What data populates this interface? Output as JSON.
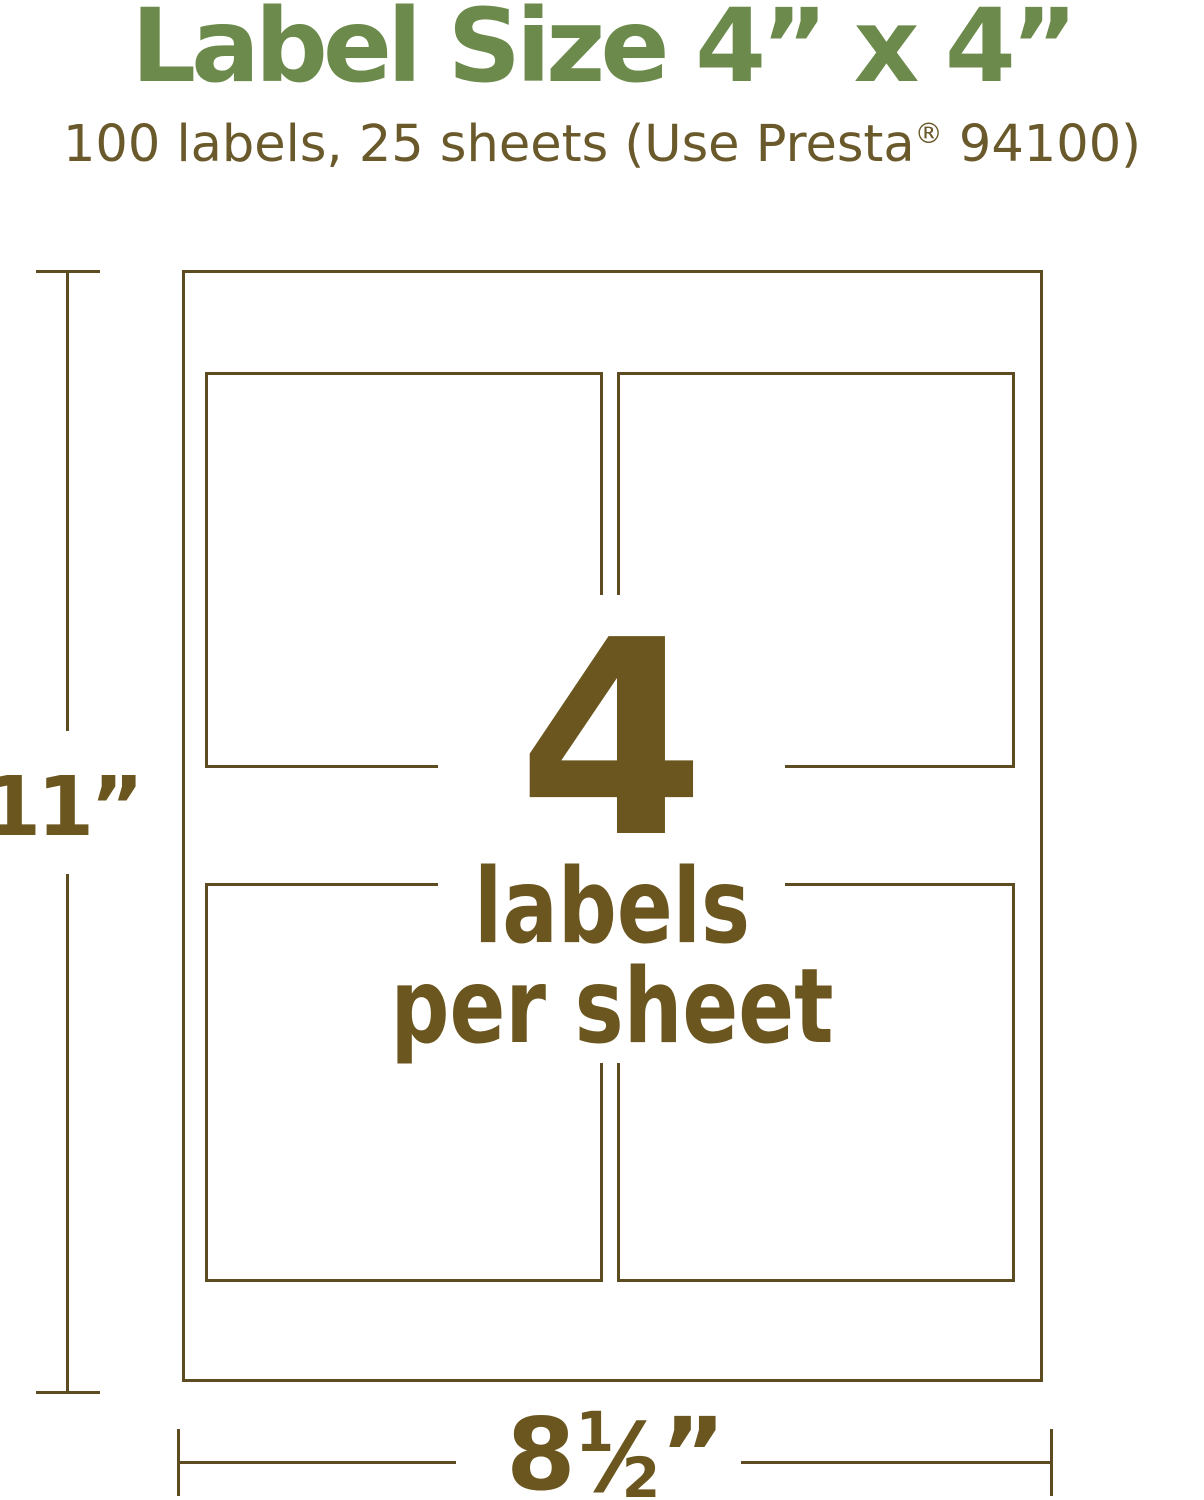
{
  "title": {
    "text": "Label Size 4” x 4”"
  },
  "subtitle": {
    "prefix": "100 labels, 25 sheets (Use Presta",
    "registered_mark": "®",
    "suffix": " 94100)"
  },
  "sheet_diagram": {
    "count": "4",
    "caption_line1": "labels",
    "caption_line2": "per sheet",
    "height_dimension_label": "11”",
    "width_dimension": {
      "whole": "8",
      "numerator": "1",
      "fraction_slash": "⁄",
      "denominator": "2",
      "inch_mark": "”"
    }
  },
  "colors": {
    "title_green": "#6c8a4b",
    "subtitle_brown": "#6a592b",
    "line_brown": "#5d4b22",
    "text_brown": "#6b561f",
    "background": "#ffffff"
  }
}
